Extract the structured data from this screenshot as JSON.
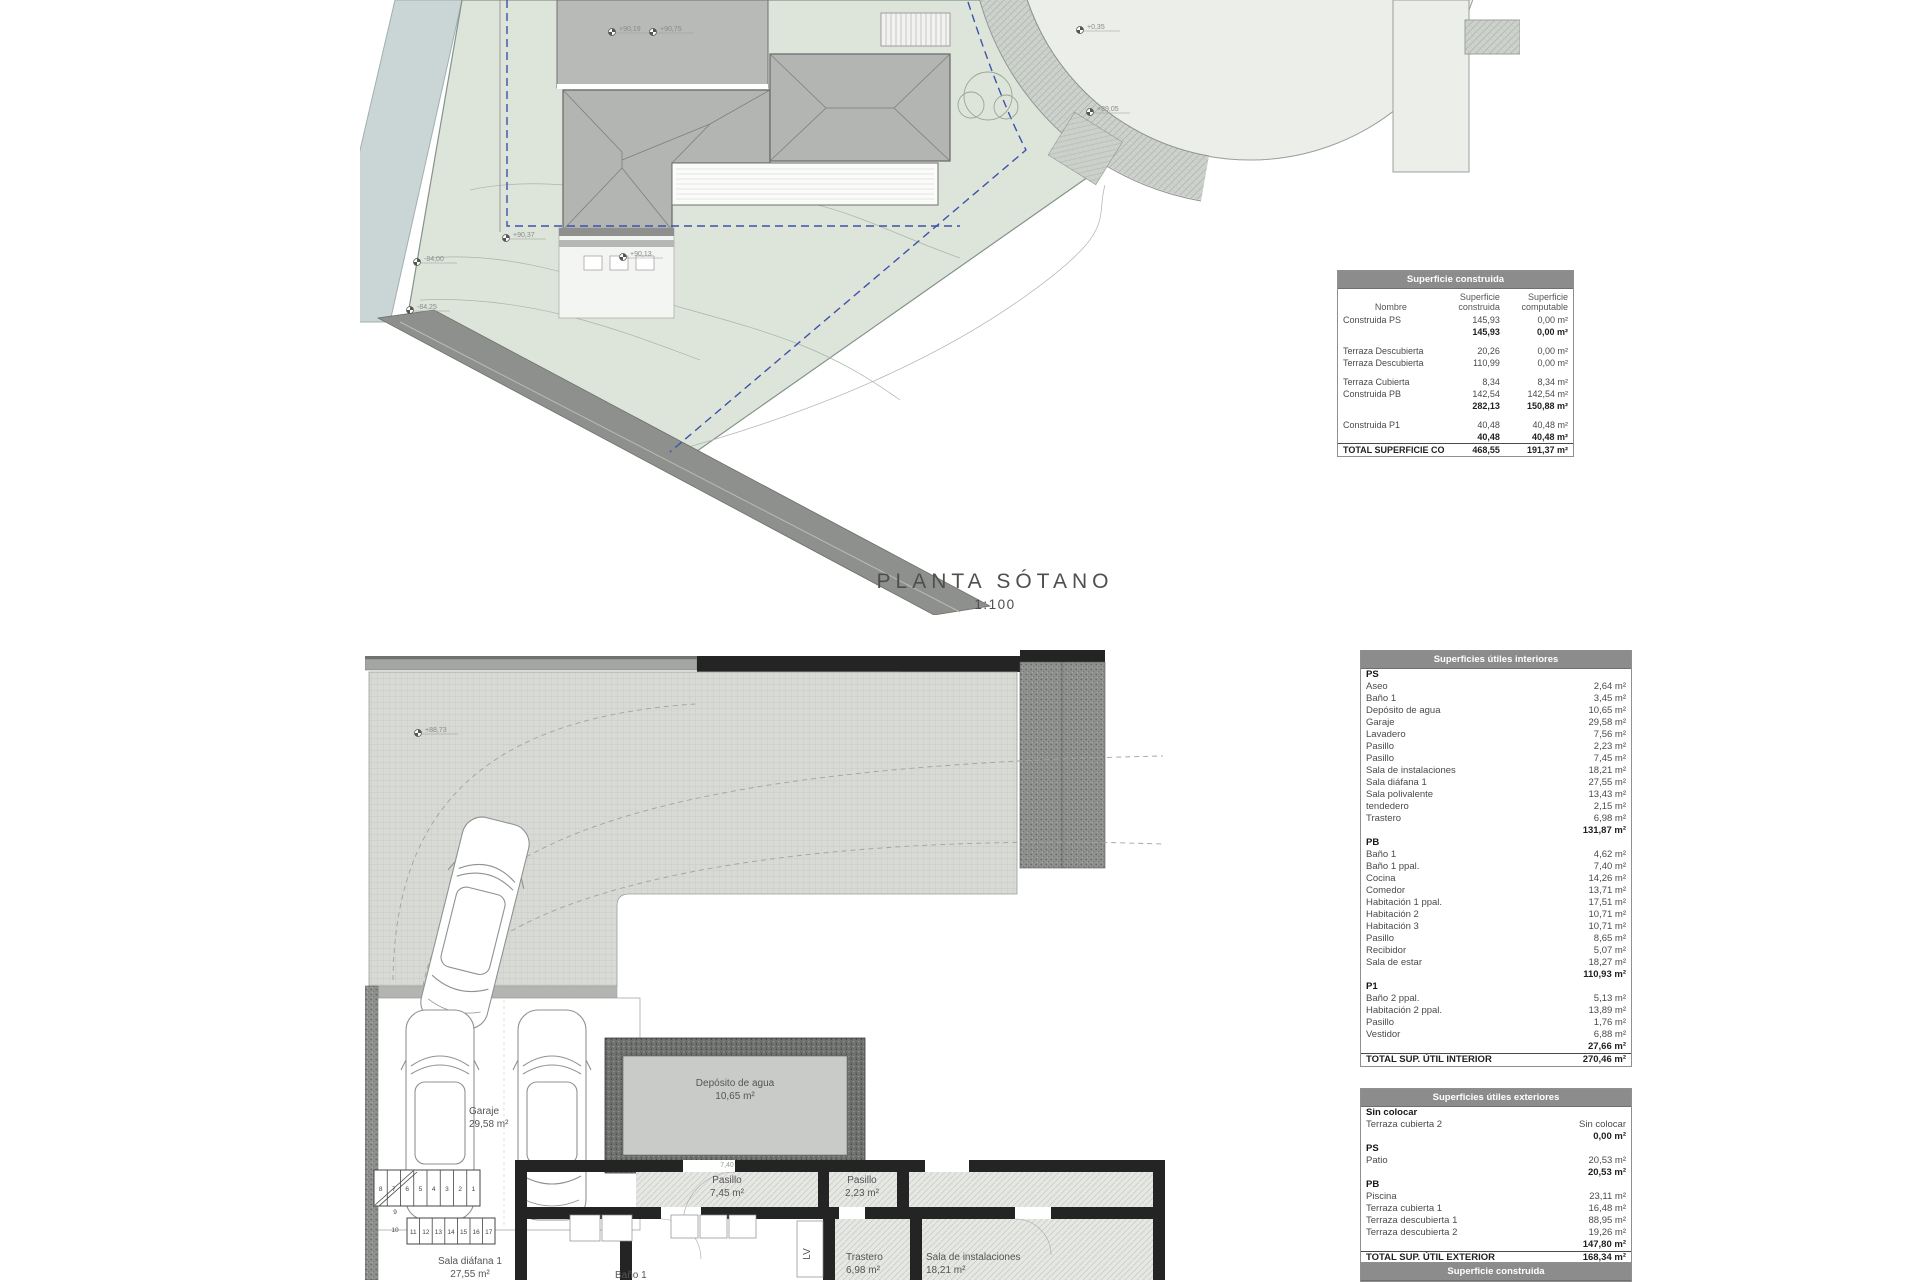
{
  "title": {
    "text": "PLANTA SÓTANO",
    "scale": "1:100"
  },
  "colors": {
    "plot_green": "#dde5db",
    "water": "#c9d6d5",
    "roof_gray": "#b2b5b1",
    "road_dark": "#8d908c",
    "table_header_bg": "#8c8c8c",
    "dashed_boundary_blue": "#3d52a8",
    "wall_black": "#242424"
  },
  "tables": {
    "construida": {
      "title": "Superficie construida",
      "columns": [
        "Nombre",
        "Superficie construida",
        "Superficie computable"
      ],
      "rows": [
        {
          "c": [
            "Construida PS",
            "145,93",
            "0,00 m²"
          ]
        },
        {
          "c": [
            "",
            "145,93",
            "0,00 m²"
          ],
          "b": 1
        },
        {
          "sp": 1
        },
        {
          "c": [
            "Terraza Descubierta",
            "20,26",
            "0,00 m²"
          ]
        },
        {
          "c": [
            "Terraza Descubierta",
            "110,99",
            "0,00 m²"
          ]
        },
        {
          "sp": 1
        },
        {
          "c": [
            "Terraza Cubierta",
            "8,34",
            "8,34 m²"
          ]
        },
        {
          "c": [
            "Construida PB",
            "142,54",
            "142,54 m²"
          ]
        },
        {
          "c": [
            "",
            "282,13",
            "150,88 m²"
          ],
          "b": 1
        },
        {
          "sp": 1
        },
        {
          "c": [
            "Construida P1",
            "40,48",
            "40,48 m²"
          ]
        },
        {
          "c": [
            "",
            "40,48",
            "40,48 m²"
          ],
          "b": 1
        },
        {
          "c": [
            "TOTAL SUPERFICIE CONSTRUIDA:",
            "468,55",
            "191,37 m²"
          ],
          "b": 1,
          "t": 1
        }
      ]
    },
    "interiores": {
      "title": "Superficies útiles interiores",
      "rows": [
        {
          "h": "PS"
        },
        {
          "c": [
            "Aseo",
            "2,64 m²"
          ]
        },
        {
          "c": [
            "Baño 1",
            "3,45 m²"
          ]
        },
        {
          "c": [
            "Depósito de agua",
            "10,65 m²"
          ]
        },
        {
          "c": [
            "Garaje",
            "29,58 m²"
          ]
        },
        {
          "c": [
            "Lavadero",
            "7,56 m²"
          ]
        },
        {
          "c": [
            "Pasillo",
            "2,23 m²"
          ]
        },
        {
          "c": [
            "Pasillo",
            "7,45 m²"
          ]
        },
        {
          "c": [
            "Sala de instalaciones",
            "18,21 m²"
          ]
        },
        {
          "c": [
            "Sala diáfana 1",
            "27,55 m²"
          ]
        },
        {
          "c": [
            "Sala polivalente",
            "13,43 m²"
          ]
        },
        {
          "c": [
            "tendedero",
            "2,15 m²"
          ]
        },
        {
          "c": [
            "Trastero",
            "6,98 m²"
          ]
        },
        {
          "c": [
            "",
            "131,87 m²"
          ],
          "b": 1
        },
        {
          "h": "PB"
        },
        {
          "c": [
            "Baño 1",
            "4,62 m²"
          ]
        },
        {
          "c": [
            "Baño 1 ppal.",
            "7,40 m²"
          ]
        },
        {
          "c": [
            "Cocina",
            "14,26 m²"
          ]
        },
        {
          "c": [
            "Comedor",
            "13,71 m²"
          ]
        },
        {
          "c": [
            "Habitación 1 ppal.",
            "17,51 m²"
          ]
        },
        {
          "c": [
            "Habitación 2",
            "10,71 m²"
          ]
        },
        {
          "c": [
            "Habitación 3",
            "10,71 m²"
          ]
        },
        {
          "c": [
            "Pasillo",
            "8,65 m²"
          ]
        },
        {
          "c": [
            "Recibidor",
            "5,07 m²"
          ]
        },
        {
          "c": [
            "Sala de estar",
            "18,27 m²"
          ]
        },
        {
          "c": [
            "",
            "110,93 m²"
          ],
          "b": 1
        },
        {
          "h": "P1"
        },
        {
          "c": [
            "Baño 2 ppal.",
            "5,13 m²"
          ]
        },
        {
          "c": [
            "Habitación 2 ppal.",
            "13,89 m²"
          ]
        },
        {
          "c": [
            "Pasillo",
            "1,76 m²"
          ]
        },
        {
          "c": [
            "Vestidor",
            "6,88 m²"
          ]
        },
        {
          "c": [
            "",
            "27,66 m²"
          ],
          "b": 1
        },
        {
          "c": [
            "TOTAL SUP. ÚTIL INTERIOR",
            "270,46 m²"
          ],
          "b": 1,
          "t": 1
        }
      ]
    },
    "exteriores": {
      "title": "Superficies útiles exteriores",
      "rows": [
        {
          "h": "Sin colocar"
        },
        {
          "c": [
            "Terraza cubierta 2",
            "Sin colocar"
          ]
        },
        {
          "c": [
            "",
            "0,00 m²"
          ],
          "b": 1
        },
        {
          "h": "PS"
        },
        {
          "c": [
            "Patio",
            "20,53 m²"
          ]
        },
        {
          "c": [
            "",
            "20,53 m²"
          ],
          "b": 1
        },
        {
          "h": "PB"
        },
        {
          "c": [
            "Piscina",
            "23,11 m²"
          ]
        },
        {
          "c": [
            "Terraza cubierta 1",
            "16,48 m²"
          ]
        },
        {
          "c": [
            "Terraza descubierta 1",
            "88,95 m²"
          ]
        },
        {
          "c": [
            "Terraza descubierta 2",
            "19,26 m²"
          ]
        },
        {
          "c": [
            "",
            "147,80 m²"
          ],
          "b": 1
        },
        {
          "c": [
            "TOTAL SUP. ÚTIL EXTERIOR",
            "168,34 m²"
          ],
          "b": 1,
          "t": 1
        }
      ]
    },
    "next_table_title": "Superficie construida"
  },
  "site_plan": {
    "markers": [
      {
        "x": 252,
        "y": 32,
        "label": "+90,19"
      },
      {
        "x": 293,
        "y": 32,
        "label": "+90,75"
      },
      {
        "x": 720,
        "y": 30,
        "label": "+0,35"
      },
      {
        "x": 730,
        "y": 112,
        "label": "+89,05"
      },
      {
        "x": 146,
        "y": 238,
        "label": "+90,37"
      },
      {
        "x": 263,
        "y": 257,
        "label": "+90,13"
      },
      {
        "x": 57,
        "y": 262,
        "label": "-84,00"
      },
      {
        "x": 50,
        "y": 310,
        "label": "-84,25"
      }
    ]
  },
  "basement_plan": {
    "markers": [
      {
        "x": 53,
        "y": 85,
        "label": "+88,73"
      }
    ],
    "labels": [
      {
        "x": 104,
        "y": 466,
        "anchor": "start",
        "lines": [
          "Garaje",
          "29,58 m²"
        ]
      },
      {
        "x": 370,
        "y": 438,
        "anchor": "middle",
        "lines": [
          "Depósito de agua",
          "10,65 m²"
        ]
      },
      {
        "x": 362,
        "y": 535,
        "anchor": "middle",
        "lines": [
          "Pasillo",
          "7,45 m²"
        ]
      },
      {
        "x": 497,
        "y": 535,
        "anchor": "middle",
        "lines": [
          "Pasillo",
          "2,23 m²"
        ]
      },
      {
        "x": 481,
        "y": 612,
        "anchor": "start",
        "lines": [
          "Trastero",
          "6,98 m²"
        ]
      },
      {
        "x": 561,
        "y": 612,
        "anchor": "start",
        "lines": [
          "Sala de instalaciones",
          "18,21 m²"
        ]
      },
      {
        "x": 105,
        "y": 616,
        "anchor": "middle",
        "lines": [
          "Sala diáfana 1",
          "27,55 m²"
        ]
      },
      {
        "x": 250,
        "y": 630,
        "anchor": "start",
        "lines": [
          "Baño 1"
        ]
      }
    ],
    "appliance_tag": "LV",
    "dim_label": "7,40",
    "stairs": {
      "upper": [
        "8",
        "7",
        "6",
        "5",
        "4",
        "3",
        "2",
        "1"
      ],
      "lower": [
        "11",
        "12",
        "13",
        "14",
        "15",
        "16",
        "17"
      ],
      "mid": [
        "9",
        "10"
      ]
    }
  }
}
